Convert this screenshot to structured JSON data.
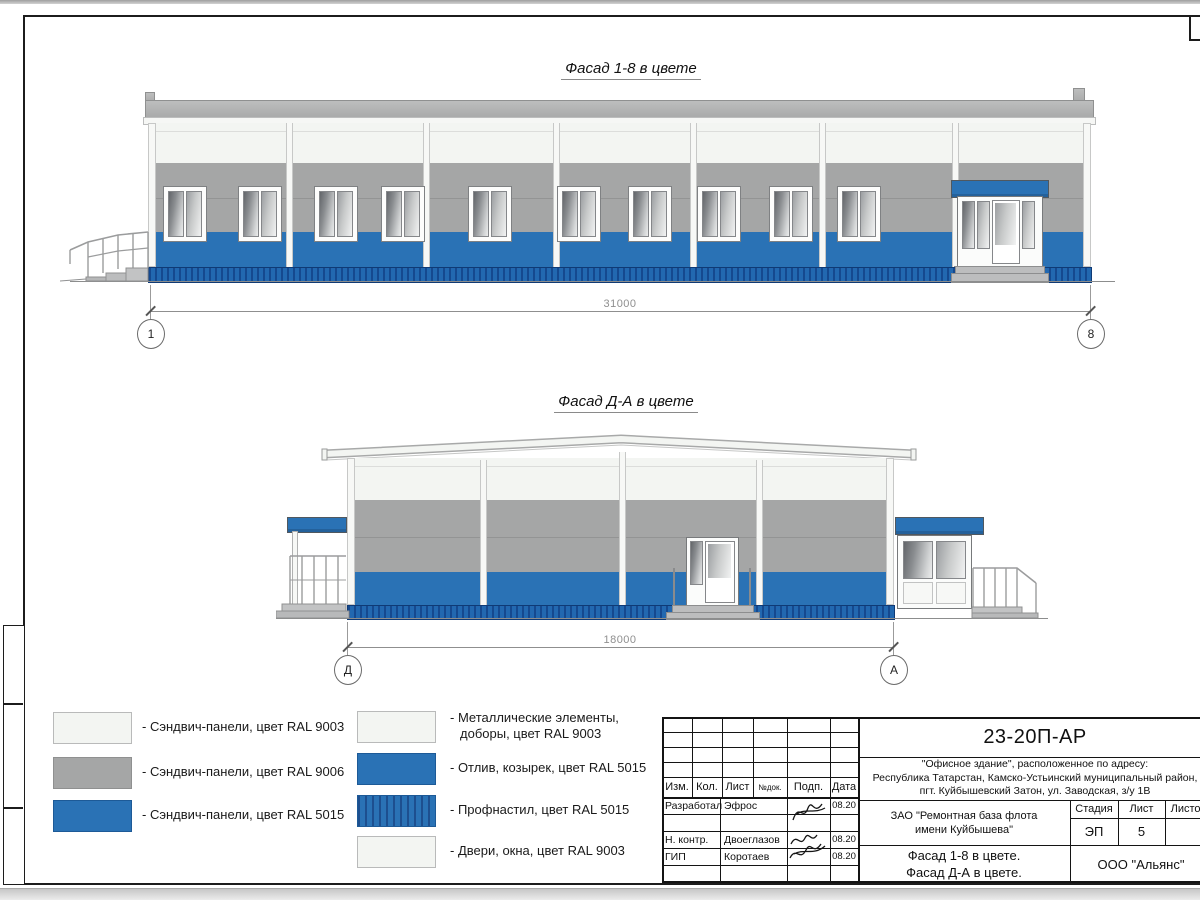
{
  "drawing": {
    "facade1": {
      "title": "Фасад 1-8 в цвете",
      "dim": "31000",
      "axis_left": "1",
      "axis_right": "8"
    },
    "facade2": {
      "title": "Фасад Д-А в цвете",
      "dim": "18000",
      "axis_left": "Д",
      "axis_right": "А"
    },
    "legend_left": [
      {
        "label": "- Сэндвич-панели, цвет RAL 9003"
      },
      {
        "label": "- Сэндвич-панели, цвет RAL 9006"
      },
      {
        "label": "- Сэндвич-панели, цвет RAL 5015"
      }
    ],
    "legend_right": [
      {
        "label": "- Металлические элементы, доборы, цвет RAL 9003"
      },
      {
        "label": "- Отлив, козырек, цвет RAL 5015"
      },
      {
        "label": "- Профнастил, цвет RAL 5015"
      },
      {
        "label": "- Двери, окна, цвет RAL 9003"
      }
    ],
    "titleblock": {
      "code": "23-20П-АР",
      "address1": "\"Офисное здание\", расположенное по адресу:",
      "address2": "Республика Татарстан, Камско-Устьинский муниципальный район,",
      "address3": "пгт. Куйбышевский Затон, ул. Заводская, з/у 1В",
      "cols": {
        "c1": "Изм.",
        "c2": "Кол.",
        "c3": "Лист",
        "c4": "№док.",
        "c5": "Подп.",
        "c6": "Дата"
      },
      "rows": [
        {
          "role": "Разработал",
          "name": "Эфрос",
          "date": "08.20"
        },
        {
          "role": "Н. контр.",
          "name": "Двоеглазов",
          "date": "08.20"
        },
        {
          "role": "ГИП",
          "name": "Коротаев",
          "date": "08.20"
        }
      ],
      "client": "ЗАО \"Ремонтная база флота имени Куйбышева\"",
      "stage_label": "Стадия",
      "sheet_label": "Лист",
      "sheets_label": "Листов",
      "stage": "ЭП",
      "sheet": "5",
      "title1": "Фасад 1-8 в цвете.",
      "title2": "Фасад Д-А в цвете.",
      "company": "ООО \"Альянс\""
    },
    "colors": {
      "ral9003_white": "#f3f5f2",
      "ral9006_gray": "#a5a6a6",
      "ral5015_blue": "#2a72b5",
      "plinth_blue": "#1d5fa9"
    }
  }
}
